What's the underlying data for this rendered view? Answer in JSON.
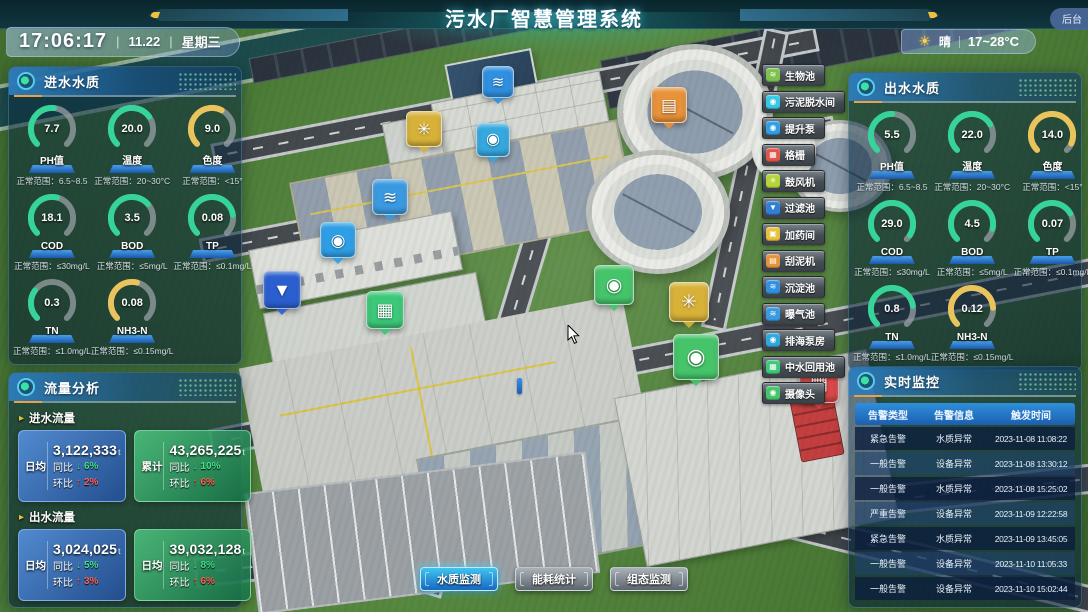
{
  "header": {
    "title": "污水厂智慧管理系统",
    "clock": {
      "time": "17:06:17",
      "sep": "|",
      "date": "11.22",
      "weekday": "星期三"
    },
    "weather": {
      "icon_glyph": "☀",
      "condition": "晴",
      "range": "17~28°C"
    },
    "backend_label": "后台"
  },
  "inlet_panel": {
    "title": "进水水质",
    "gauges": [
      {
        "name": "ph",
        "label": "PH值",
        "value": "7.7",
        "range": "正常范围：6.5~8.5",
        "color": "#35d49a",
        "fraction": 0.52
      },
      {
        "name": "temperature",
        "label": "温度",
        "value": "20.0",
        "range": "正常范围：20~30°C",
        "color": "#35d49a",
        "fraction": 0.7
      },
      {
        "name": "chroma",
        "label": "色度",
        "value": "9.0",
        "range": "正常范围：<15°",
        "color": "#e9c35b",
        "fraction": 0.6
      },
      {
        "name": "cod",
        "label": "COD",
        "value": "18.1",
        "range": "正常范围：≤30mg/L",
        "color": "#35d49a",
        "fraction": 0.55
      },
      {
        "name": "bod",
        "label": "BOD",
        "value": "3.5",
        "range": "正常范围：≤5mg/L",
        "color": "#35d49a",
        "fraction": 0.68
      },
      {
        "name": "tp",
        "label": "TP",
        "value": "0.08",
        "range": "正常范围：≤0.1mg/L",
        "color": "#35d49a",
        "fraction": 0.8
      },
      {
        "name": "tn",
        "label": "TN",
        "value": "0.3",
        "range": "正常范围：≤1.0mg/L",
        "color": "#35d49a",
        "fraction": 0.3
      },
      {
        "name": "nh3n",
        "label": "NH3-N",
        "value": "0.08",
        "range": "正常范围：≤0.15mg/L",
        "color": "#e9c35b",
        "fraction": 0.55
      }
    ]
  },
  "outlet_panel": {
    "title": "出水水质",
    "gauges": [
      {
        "name": "ph",
        "label": "PH值",
        "value": "5.5",
        "range": "正常范围：6.5~8.5",
        "color": "#35d49a",
        "fraction": 0.5
      },
      {
        "name": "temperature",
        "label": "温度",
        "value": "22.0",
        "range": "正常范围：20~30°C",
        "color": "#35d49a",
        "fraction": 0.72
      },
      {
        "name": "chroma",
        "label": "色度",
        "value": "14.0",
        "range": "正常范围：<15°",
        "color": "#e9c35b",
        "fraction": 0.92
      },
      {
        "name": "cod",
        "label": "COD",
        "value": "29.0",
        "range": "正常范围：≤30mg/L",
        "color": "#35d49a",
        "fraction": 0.95
      },
      {
        "name": "bod",
        "label": "BOD",
        "value": "4.5",
        "range": "正常范围：≤5mg/L",
        "color": "#35d49a",
        "fraction": 0.88
      },
      {
        "name": "tp",
        "label": "TP",
        "value": "0.07",
        "range": "正常范围：≤0.1mg/L",
        "color": "#35d49a",
        "fraction": 0.72
      },
      {
        "name": "tn",
        "label": "TN",
        "value": "0.8",
        "range": "正常范围：≤1.0mg/L",
        "color": "#35d49a",
        "fraction": 0.8
      },
      {
        "name": "nh3n",
        "label": "NH3-N",
        "value": "0.12",
        "range": "正常范围：≤0.15mg/L",
        "color": "#e9c35b",
        "fraction": 0.82
      }
    ]
  },
  "flow_panel": {
    "title": "流量分析",
    "arrow_glyph": "▸",
    "yoy_label": "同比",
    "mom_label": "环比",
    "down_glyph": "↓",
    "up_glyph": "↑",
    "sections": [
      {
        "label": "进水流量",
        "cards": [
          {
            "tag": "日均",
            "value": "3,122,333",
            "unit": "t",
            "yoy": "6%",
            "mom": "2%",
            "theme": "blue"
          },
          {
            "tag": "累计",
            "value": "43,265,225",
            "unit": "t",
            "yoy": "10%",
            "mom": "6%",
            "theme": "green"
          }
        ]
      },
      {
        "label": "出水流量",
        "cards": [
          {
            "tag": "日均",
            "value": "3,024,025",
            "unit": "t",
            "yoy": "5%",
            "mom": "3%",
            "theme": "blue"
          },
          {
            "tag": "日均",
            "value": "39,032,128",
            "unit": "t",
            "yoy": "8%",
            "mom": "6%",
            "theme": "green"
          }
        ]
      }
    ]
  },
  "monitor_panel": {
    "title": "实时监控",
    "headers": [
      "告警类型",
      "告警信息",
      "触发时间"
    ],
    "rows": [
      [
        "紧急告警",
        "水质异常",
        "2023-11-08 11:08:22"
      ],
      [
        "一般告警",
        "设备异常",
        "2023-11-08 13:30:12"
      ],
      [
        "一般告警",
        "水质异常",
        "2023-11-08 15:25:02"
      ],
      [
        "严重告警",
        "设备异常",
        "2023-11-09 12:22:58"
      ],
      [
        "紧急告警",
        "水质异常",
        "2023-11-09 13:45:05"
      ],
      [
        "一般告警",
        "设备异常",
        "2023-11-10 11:05:33"
      ],
      [
        "一般告警",
        "设备异常",
        "2023-11-10 15:02:44"
      ]
    ]
  },
  "legend": [
    {
      "name": "biological-pool",
      "label": "生物池",
      "color": "#7cc24c",
      "glyph": "≋"
    },
    {
      "name": "sludge-dewatering-room",
      "label": "污泥脱水间",
      "color": "#35c8e8",
      "glyph": "◉"
    },
    {
      "name": "lift-pump",
      "label": "提升泵",
      "color": "#2e9fe6",
      "glyph": "◉"
    },
    {
      "name": "bar-screen",
      "label": "格栅",
      "color": "#e05548",
      "glyph": "▦"
    },
    {
      "name": "blower",
      "label": "鼓风机",
      "color": "#b6d435",
      "glyph": "✳"
    },
    {
      "name": "filter-pool",
      "label": "过滤池",
      "color": "#2f7fd6",
      "glyph": "▼"
    },
    {
      "name": "dosing-room",
      "label": "加药间",
      "color": "#e8c23a",
      "glyph": "▣"
    },
    {
      "name": "sludge-scraper",
      "label": "刮泥机",
      "color": "#e8923a",
      "glyph": "▤"
    },
    {
      "name": "sedimentation-pool",
      "label": "沉淀池",
      "color": "#2f8fe0",
      "glyph": "≋"
    },
    {
      "name": "aeration-pool",
      "label": "曝气池",
      "color": "#3a9ae0",
      "glyph": "≋"
    },
    {
      "name": "sea-discharge-pump-house",
      "label": "排海泵房",
      "color": "#2fa8e0",
      "glyph": "◉"
    },
    {
      "name": "water-reuse-pool",
      "label": "中水回用池",
      "color": "#3cc878",
      "glyph": "▦"
    },
    {
      "name": "camera",
      "label": "摄像头",
      "color": "#46c46a",
      "glyph": "◉"
    }
  ],
  "bottom_tabs": [
    {
      "name": "water-quality-monitor",
      "label": "水质监测",
      "active": true
    },
    {
      "name": "energy-stats",
      "label": "能耗统计",
      "active": false
    },
    {
      "name": "scada-monitor",
      "label": "组态监测",
      "active": false
    }
  ],
  "markers": [
    {
      "name": "marker-sedimentation-pool",
      "x": 497,
      "y": 81,
      "size": 30,
      "color": "#2f8fe0",
      "glyph": "≋"
    },
    {
      "name": "marker-blower-1",
      "x": 423,
      "y": 128,
      "size": 34,
      "color": "#d8b238",
      "glyph": "✳"
    },
    {
      "name": "marker-lift-pump",
      "x": 492,
      "y": 139,
      "size": 32,
      "color": "#35a8e0",
      "glyph": "◉"
    },
    {
      "name": "marker-sludge-scraper",
      "x": 668,
      "y": 104,
      "size": 34,
      "color": "#e8923a",
      "glyph": "▤"
    },
    {
      "name": "marker-aeration-pool",
      "x": 389,
      "y": 196,
      "size": 34,
      "color": "#3a9ae0",
      "glyph": "≋"
    },
    {
      "name": "marker-pump-2",
      "x": 337,
      "y": 239,
      "size": 34,
      "color": "#2e9fe6",
      "glyph": "◉"
    },
    {
      "name": "marker-filter-pool",
      "x": 281,
      "y": 289,
      "size": 36,
      "color": "#2b5fd0",
      "glyph": "▼"
    },
    {
      "name": "marker-water-reuse-pool",
      "x": 384,
      "y": 309,
      "size": 36,
      "color": "#3cc878",
      "glyph": "▦"
    },
    {
      "name": "marker-camera-1",
      "x": 613,
      "y": 284,
      "size": 38,
      "color": "#46c46a",
      "glyph": "◉"
    },
    {
      "name": "marker-blower-2",
      "x": 688,
      "y": 301,
      "size": 38,
      "color": "#d8b238",
      "glyph": "✳"
    },
    {
      "name": "marker-camera-2",
      "x": 695,
      "y": 356,
      "size": 44,
      "color": "#46c46a",
      "glyph": "◉"
    },
    {
      "name": "marker-bar-screen",
      "x": 818,
      "y": 382,
      "size": 38,
      "color": "#d84848",
      "glyph": "▦"
    }
  ]
}
